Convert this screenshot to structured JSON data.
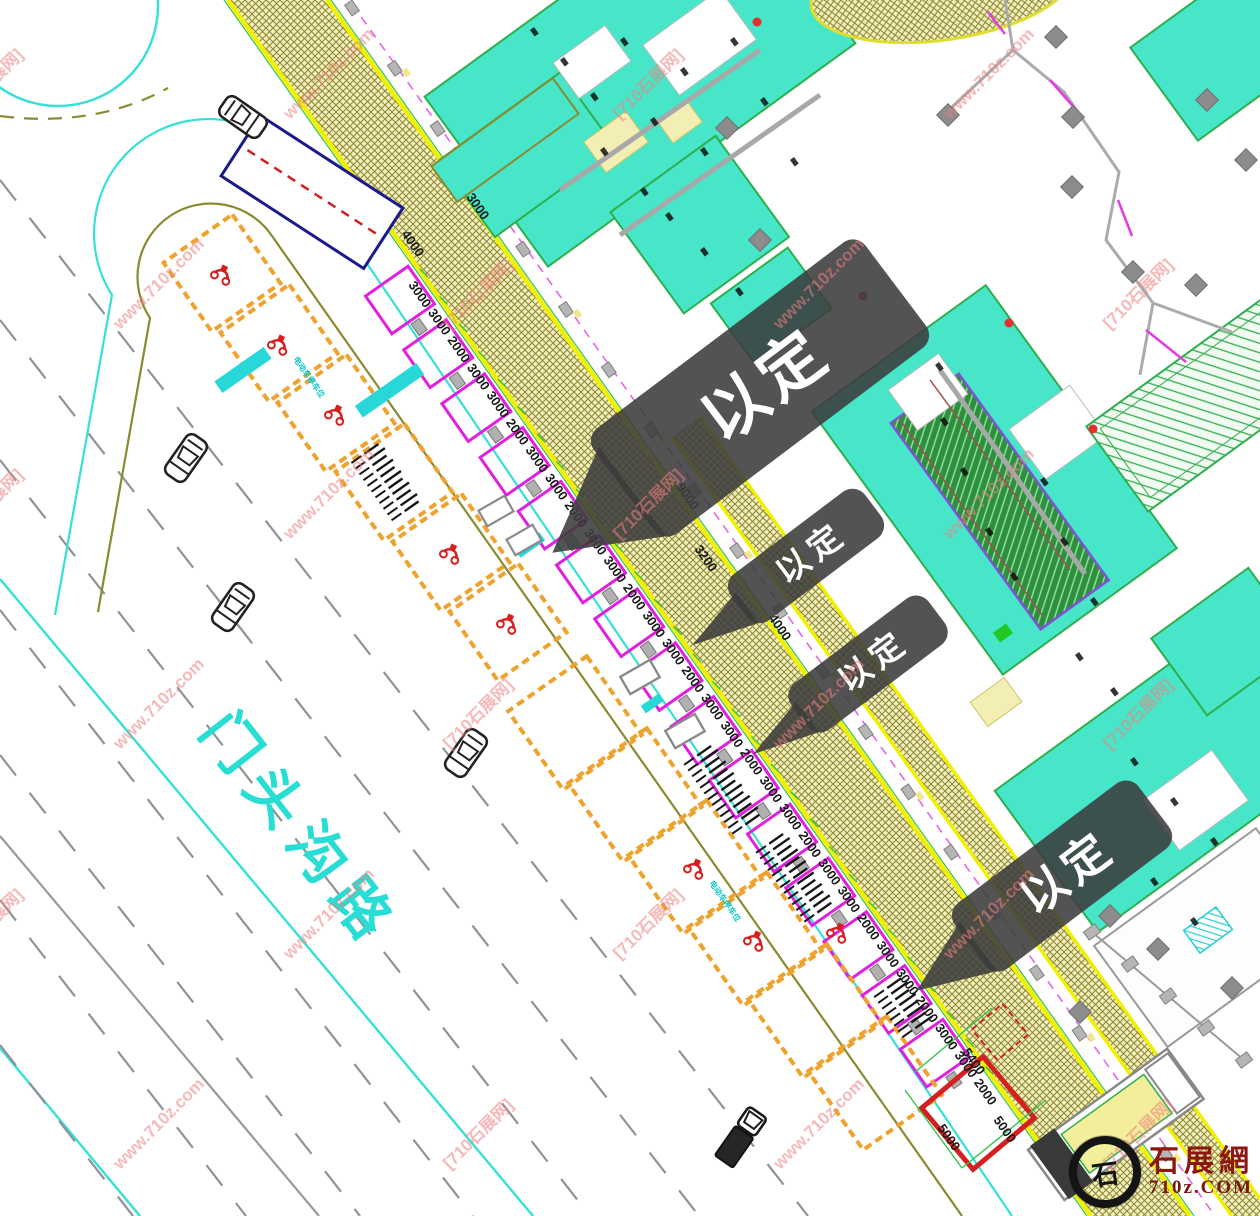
{
  "page": {
    "background": "#ffffff"
  },
  "road": {
    "name": "门头沟路",
    "color": "#28ddd4"
  },
  "watermark": {
    "line1": "[710石展网]",
    "line2": "www.710z.com",
    "color": "#ef8080"
  },
  "callouts": {
    "items": [
      "以定",
      "以定",
      "以定",
      "以定"
    ],
    "bg_color": "#3b3b3b",
    "text_color": "#ffffff"
  },
  "dimensions": {
    "band_sequence": [
      "3000",
      "3000",
      "2000",
      "3000",
      "3000",
      "2000",
      "3000",
      "3000",
      "2000",
      "3000",
      "3000",
      "2000",
      "3000",
      "3000",
      "2000",
      "3000",
      "3000",
      "2000",
      "3000",
      "3000",
      "2000",
      "3000",
      "3000",
      "2000",
      "3000",
      "3000",
      "2000",
      "3000",
      "3000",
      "2000"
    ],
    "top": [
      "4000",
      "3000"
    ],
    "gap": [
      "9000",
      "3200",
      "4000"
    ],
    "plot": [
      "5400",
      "5000",
      "5000"
    ]
  },
  "labels": {
    "ebike_parking": "电动车停车位"
  },
  "logo": {
    "icon_char": "石",
    "site_name": "石展網",
    "domain": "710z.COM"
  },
  "colors": {
    "band_edge": "#f0f000",
    "hatch": "#8f892c",
    "hatch_bg": "#f2efc2",
    "teal_building": "#47e6c8",
    "building_stroke": "#2fae4e",
    "magenta": "#e020e0",
    "orange": "#efa32e",
    "cyan": "#25dcd2",
    "olive": "#8a8a30",
    "navy": "#1a1a8c",
    "red": "#d81f1f",
    "gray_lane": "#8f9296",
    "dim_green": "#35c24a"
  },
  "icons": {
    "logo_ring": "ink-circle-icon",
    "car": "car-icon",
    "truck": "truck-icon",
    "motorcycle": "motorcycle-icon",
    "bike_rack": "bike-rack-icon",
    "column": "column-icon",
    "callout_arrow": "callout-arrow-icon"
  }
}
